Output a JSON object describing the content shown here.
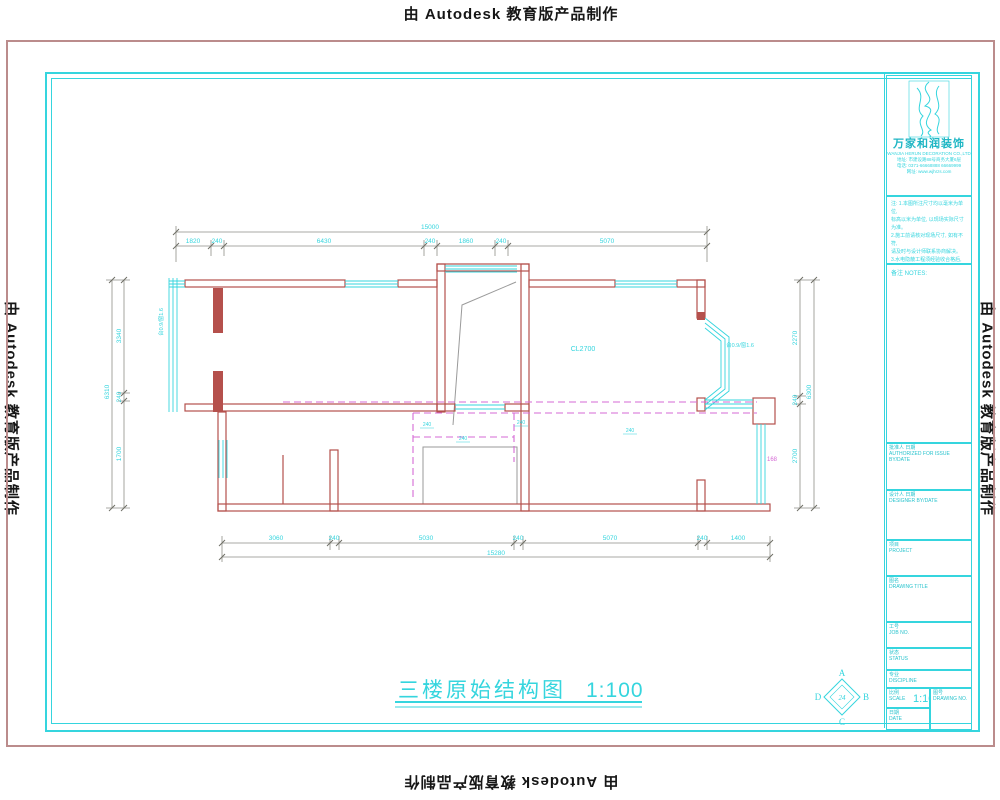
{
  "watermark": {
    "text": "由 Autodesk 教育版产品制作"
  },
  "drawing": {
    "title": "三楼原始结构图",
    "scale": "1:100",
    "labels": {
      "ceiling_height": "CL2700",
      "window_tag_left": "台0.9/窗1.6",
      "window_tag_right": "台0.9/窗1.6",
      "beam_mark": "240",
      "area_mark": "168"
    },
    "dims": {
      "top": {
        "overall": "15000",
        "segments": [
          "1820",
          "240",
          "6430",
          "240",
          "1860",
          "240",
          "5070"
        ]
      },
      "bottom": {
        "overall": "15280",
        "segments": [
          "3060",
          "240",
          "5030",
          "240",
          "5070",
          "240",
          "1400"
        ]
      },
      "left": {
        "overall": "6310",
        "segments": [
          "3340",
          "240",
          "1700"
        ]
      },
      "right": {
        "overall": "6300",
        "segments": [
          "2270",
          "240",
          "2700"
        ]
      }
    }
  },
  "compass": {
    "north": "A",
    "east": "B",
    "south": "C",
    "west": "D",
    "center": "24"
  },
  "title_block": {
    "company_name": "万家和润装饰",
    "company_name_en": "WANJIA HERUN DECORATION CO.,LTD",
    "address_lines": [
      "地址: 市建设路88号商务大厦6层",
      "电话: 0371-66668888  66669999",
      "网址: www.wjhrzs.com"
    ],
    "notes_title": "备注 NOTES:",
    "notes_lines": [
      "注: 1.本图所注尺寸均以毫米为单位,",
      "标高以米为单位, 以现场实际尺寸为准。",
      "2.施工前请核对现场尺寸, 如有不符,",
      "请及时与设计师联系协商解决。",
      "3.水电隐蔽工程须经验收合格后,",
      "方可进行下道工序施工。",
      "4.未尽事宜参照国家相关规范执行。"
    ],
    "fields": {
      "authorized": {
        "cn": "批准人 日期",
        "en": "AUTHORIZED FOR ISSUE BY/DATE"
      },
      "designer": {
        "cn": "设计人 日期",
        "en": "DESIGNER BY/DATE"
      },
      "project": {
        "cn": "项目",
        "en": "PROJECT"
      },
      "drawing_title": {
        "cn": "图名",
        "en": "DRAWING TITLE"
      },
      "job_no": {
        "cn": "工号",
        "en": "JOB NO."
      },
      "status": {
        "cn": "状态",
        "en": "STATUS"
      },
      "discipline": {
        "cn": "专业",
        "en": "DISCIPLINE"
      },
      "scale": {
        "cn": "比例",
        "en": "SCALE",
        "value": "1:100"
      },
      "drawing_no": {
        "cn": "图号",
        "en": "DRAWING NO."
      },
      "date": {
        "cn": "日期",
        "en": "DATE"
      }
    }
  }
}
